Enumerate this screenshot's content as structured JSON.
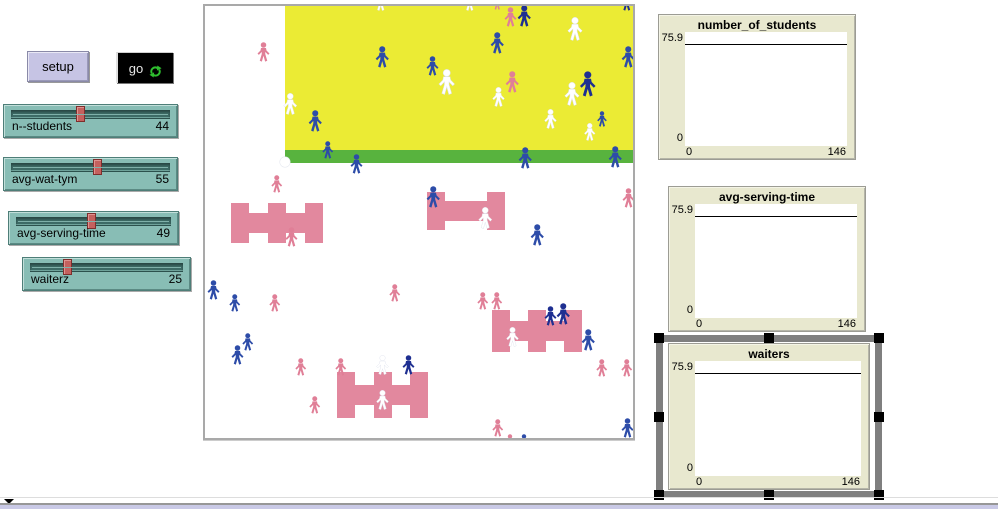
{
  "buttons": {
    "setup": "setup",
    "go": "go"
  },
  "sliders": [
    {
      "label": "n--students",
      "value": 44
    },
    {
      "label": "avg-wat-tym",
      "value": 55
    },
    {
      "label": "avg-serving-time",
      "value": 49
    },
    {
      "label": "waiterz",
      "value": 25
    }
  ],
  "plots": [
    {
      "title": "number_of_students",
      "y_max": "75.9",
      "y_min": "0",
      "x_min": "0",
      "x_max": "146",
      "selected": false,
      "pen_line_y": 75.9
    },
    {
      "title": "avg-serving-time",
      "y_max": "75.9",
      "y_min": "0",
      "x_min": "0",
      "x_max": "146",
      "selected": false,
      "pen_line_y": 75.9
    },
    {
      "title": "waiters",
      "y_max": "75.9",
      "y_min": "0",
      "x_min": "0",
      "x_max": "146",
      "selected": true,
      "pen_line_y": 75.9
    }
  ],
  "colors": {
    "white": "#FFFFFF",
    "blue": "#2D4CA8",
    "navy": "#1E2F91",
    "pink": "#E07F97",
    "table_pink": "#E2889E",
    "zone_yellow": "#EBEB34",
    "zone_green": "#58B33E",
    "go_icon_green": "#2FBF2F",
    "plot_bg": "#E8E8CF",
    "slider_teal": "#88BDB5"
  },
  "world": {
    "note": "agents:[cx,cy,size,colorKey] colorKey w|b|n|p ; tables:[x,y,w,h,stubCount] ; dots:[cx,cy,r]",
    "zones": {
      "yellow": [
        80,
        0,
        348,
        144
      ],
      "green": [
        80,
        144,
        348,
        13
      ]
    },
    "agents": [
      [
        176,
        -4,
        18,
        "w"
      ],
      [
        265,
        -4,
        18,
        "w"
      ],
      [
        292,
        -3,
        14,
        "p"
      ],
      [
        305,
        11,
        20,
        "p"
      ],
      [
        319,
        10,
        22,
        "n"
      ],
      [
        370,
        23,
        24,
        "w"
      ],
      [
        422,
        -4,
        18,
        "n"
      ],
      [
        177,
        51,
        22,
        "b"
      ],
      [
        227,
        60,
        20,
        "b"
      ],
      [
        242,
        76,
        26,
        "w"
      ],
      [
        292,
        37,
        22,
        "b"
      ],
      [
        307,
        76,
        22,
        "p"
      ],
      [
        293,
        91,
        20,
        "w"
      ],
      [
        383,
        78,
        26,
        "n"
      ],
      [
        367,
        88,
        24,
        "w"
      ],
      [
        423,
        51,
        22,
        "b"
      ],
      [
        397,
        113,
        16,
        "b"
      ],
      [
        385,
        126,
        18,
        "w"
      ],
      [
        345,
        113,
        20,
        "w"
      ],
      [
        85,
        98,
        22,
        "w"
      ],
      [
        110,
        115,
        22,
        "b"
      ],
      [
        123,
        144,
        18,
        "b"
      ],
      [
        151,
        158,
        20,
        "b"
      ],
      [
        320,
        152,
        22,
        "b"
      ],
      [
        410,
        151,
        22,
        "b"
      ],
      [
        58,
        46,
        20,
        "p"
      ],
      [
        72,
        178,
        18,
        "p"
      ],
      [
        86,
        231,
        20,
        "p"
      ],
      [
        228,
        191,
        22,
        "b"
      ],
      [
        280,
        212,
        22,
        "w"
      ],
      [
        423,
        192,
        20,
        "p"
      ],
      [
        332,
        229,
        22,
        "b"
      ],
      [
        8,
        284,
        20,
        "b"
      ],
      [
        30,
        297,
        18,
        "b"
      ],
      [
        70,
        297,
        18,
        "p"
      ],
      [
        96,
        361,
        18,
        "p"
      ],
      [
        136,
        361,
        18,
        "p"
      ],
      [
        43,
        336,
        18,
        "b"
      ],
      [
        32,
        349,
        20,
        "b"
      ],
      [
        110,
        399,
        18,
        "p"
      ],
      [
        177,
        359,
        20,
        "w"
      ],
      [
        203,
        359,
        20,
        "n"
      ],
      [
        177,
        394,
        20,
        "w"
      ],
      [
        278,
        295,
        18,
        "p"
      ],
      [
        292,
        295,
        18,
        "p"
      ],
      [
        345,
        310,
        20,
        "n"
      ],
      [
        358,
        308,
        22,
        "n"
      ],
      [
        307,
        331,
        20,
        "w"
      ],
      [
        383,
        334,
        22,
        "b"
      ],
      [
        397,
        362,
        18,
        "p"
      ],
      [
        422,
        362,
        18,
        "p"
      ],
      [
        293,
        422,
        18,
        "p"
      ],
      [
        305,
        436,
        16,
        "p"
      ],
      [
        319,
        436,
        16,
        "b"
      ],
      [
        422,
        422,
        20,
        "b"
      ],
      [
        190,
        287,
        18,
        "p"
      ]
    ],
    "tables": [
      [
        26,
        197,
        92,
        40,
        3
      ],
      [
        222,
        186,
        78,
        38,
        2
      ],
      [
        287,
        304,
        90,
        42,
        3
      ],
      [
        132,
        366,
        91,
        46,
        3
      ]
    ],
    "dots": [
      [
        80,
        156,
        5
      ]
    ]
  }
}
